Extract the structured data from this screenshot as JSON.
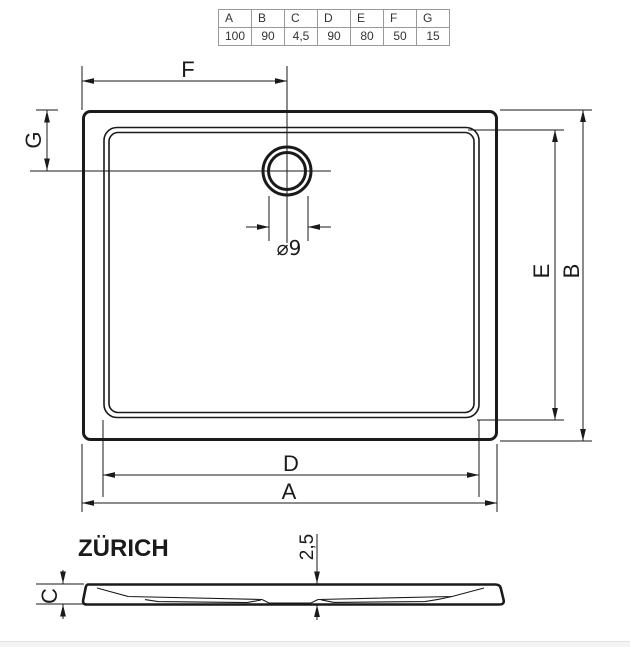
{
  "table": {
    "headers": [
      "A",
      "B",
      "C",
      "D",
      "E",
      "F",
      "G"
    ],
    "values": [
      "100",
      "90",
      "4,5",
      "90",
      "80",
      "50",
      "15"
    ]
  },
  "top_view": {
    "dim_f": "F",
    "dim_g": "G",
    "dim_e": "E",
    "dim_b": "B",
    "dim_d": "D",
    "dim_a": "A",
    "drain_diameter": "⌀9"
  },
  "side_view": {
    "model_name": "ZÜRICH",
    "dim_depth": "2,5",
    "dim_c": "C"
  },
  "colors": {
    "line": "#1a1a1a",
    "table_border": "#9a9a9a",
    "footer_band": "#f4f4f4"
  }
}
